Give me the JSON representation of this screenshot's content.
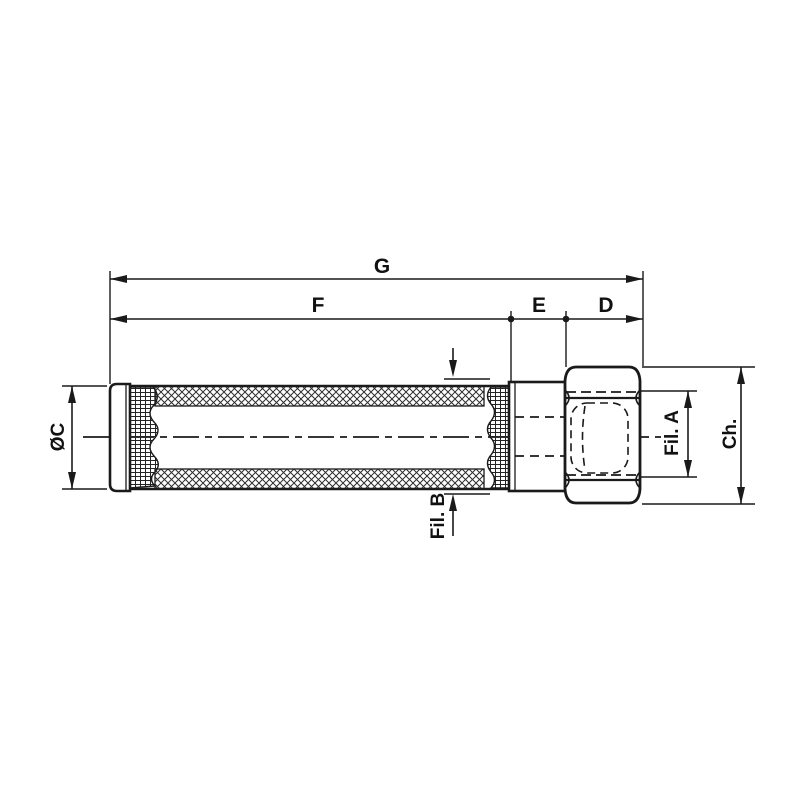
{
  "drawing": {
    "background": "#ffffff",
    "line_color": "#1a1a1a",
    "labels": {
      "overall_length": "G",
      "body_length": "F",
      "collar_width": "E",
      "nut_width": "D",
      "body_diameter": "ØC",
      "thread_body_end": "Fil. B",
      "thread_nut": "Fil. A",
      "wrench_size": "Ch."
    }
  }
}
